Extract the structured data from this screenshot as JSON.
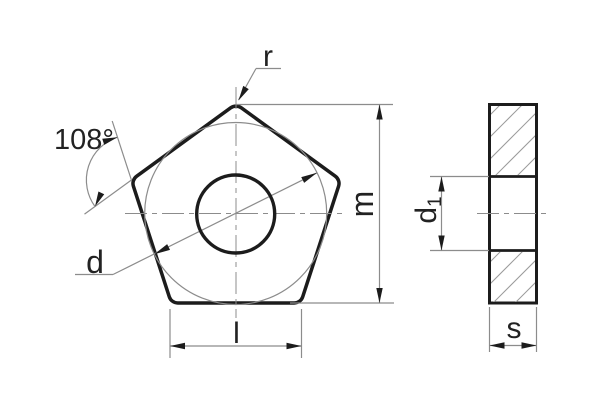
{
  "drawing": {
    "type": "technical-drawing-pentagonal-insert",
    "views": {
      "front": {
        "labels": {
          "corner_radius": "r",
          "angle": "108°",
          "inscribed_circle_diameter": "d",
          "height": "m",
          "cutting_edge_length": "l"
        }
      },
      "side": {
        "labels": {
          "hole_diameter_base": "d",
          "hole_diameter_sub": "1",
          "thickness": "s"
        }
      }
    },
    "colors": {
      "outline": "#1c1c1c",
      "thin_line": "#8c8c8c",
      "text": "#222222",
      "background": "#ffffff"
    }
  }
}
